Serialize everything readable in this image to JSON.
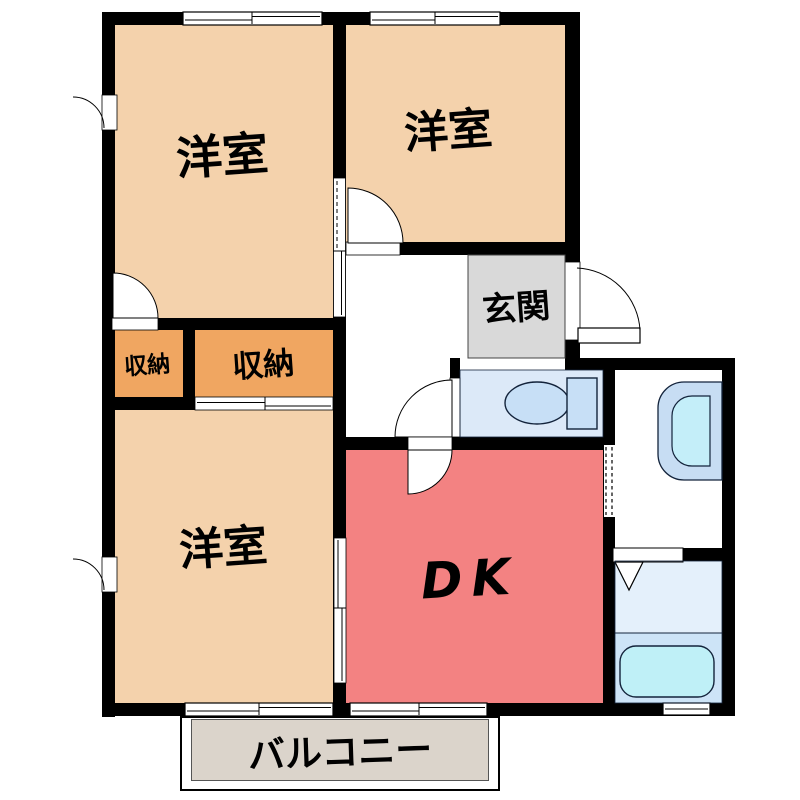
{
  "plan": {
    "type": "apartment-floorplan",
    "rooms": {
      "bedroom_top_left": {
        "label": "洋室"
      },
      "bedroom_top_right": {
        "label": "洋室"
      },
      "bedroom_bottom": {
        "label": "洋室"
      },
      "closet_small": {
        "label": "収納"
      },
      "closet_large": {
        "label": "収納"
      },
      "entrance": {
        "label": "玄関"
      },
      "dining_kitchen": {
        "label": "DK"
      },
      "balcony": {
        "label": "バルコニー"
      }
    },
    "fixtures": {
      "toilet": "toilet-icon",
      "washbasin": "washbasin-icon",
      "bathtub": "bathtub-icon"
    },
    "colors": {
      "wall": "#000000",
      "bedroom": "#F4D2AC",
      "closet": "#F0A661",
      "entrance": "#D9D9D9",
      "dining_kitchen": "#F38282",
      "toilet_room": "#DCE9F8",
      "washroom": "#FFFFFF",
      "bathroom_upper": "#E4F0FB",
      "bathroom_lower": "#CDE4F7",
      "bathtub": "#BFF0F7",
      "fixture_fill": "#C7DFF6",
      "balcony": "#DBD4CB"
    }
  }
}
